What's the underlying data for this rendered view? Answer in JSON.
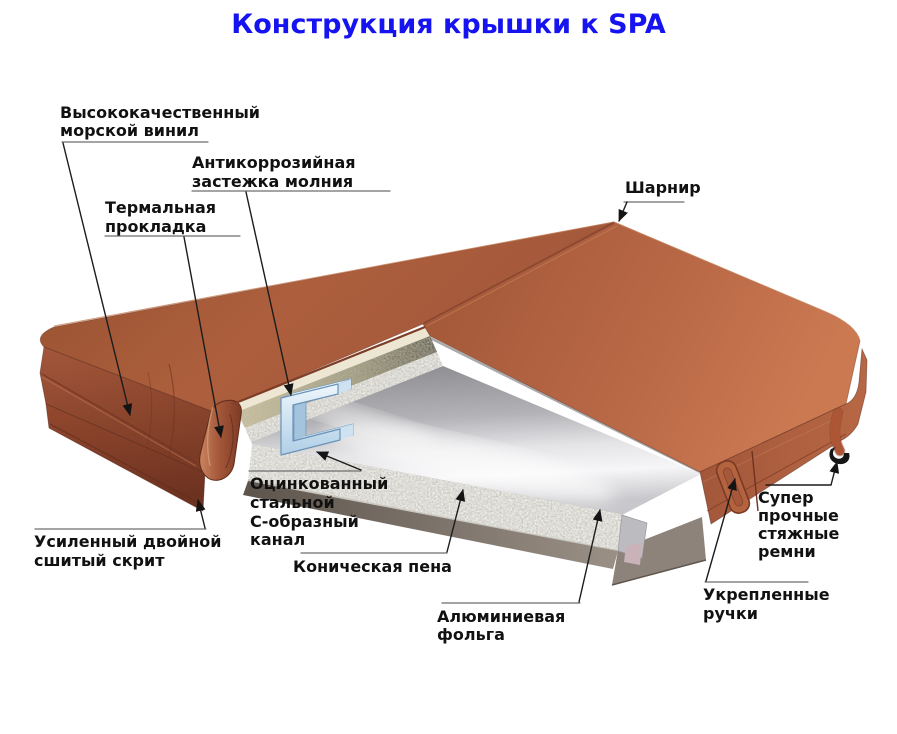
{
  "title": {
    "text": "Конструкция крышки к SPA",
    "color": "#1513ef"
  },
  "labels": {
    "vinyl": {
      "lines": [
        "Высококачественный",
        "морской винил"
      ]
    },
    "zipper": {
      "lines": [
        "Антикоррозийная",
        "застежка молния"
      ]
    },
    "thermal": {
      "lines": [
        "Термальная",
        "прокладка"
      ]
    },
    "hinge": {
      "lines": [
        "Шарнир"
      ]
    },
    "channel": {
      "lines": [
        "Оцинкованный",
        "стальной",
        "С-образный",
        "канал"
      ]
    },
    "skirt": {
      "lines": [
        "Усиленный двойной",
        "сшитый скрит"
      ]
    },
    "foam": {
      "lines": [
        "Коническая пена"
      ]
    },
    "foil": {
      "lines": [
        "Алюминиевая",
        "фольга"
      ]
    },
    "straps": {
      "lines": [
        "Супер",
        "прочные",
        "стяжные",
        "ремни"
      ]
    },
    "handles": {
      "lines": [
        "Укрепленные",
        "ручки"
      ]
    }
  },
  "colors": {
    "title": "#1513ef",
    "label_text": "#111111",
    "leader_line": "#1c1c1c",
    "vinyl_top": "#b06040",
    "vinyl_dark": "#7c3b26",
    "foam": "#f1f0ea",
    "foil": "#c8c8cc",
    "steel_channel": "#cfe3f3",
    "thermal_gasket": "#c7bd96"
  }
}
